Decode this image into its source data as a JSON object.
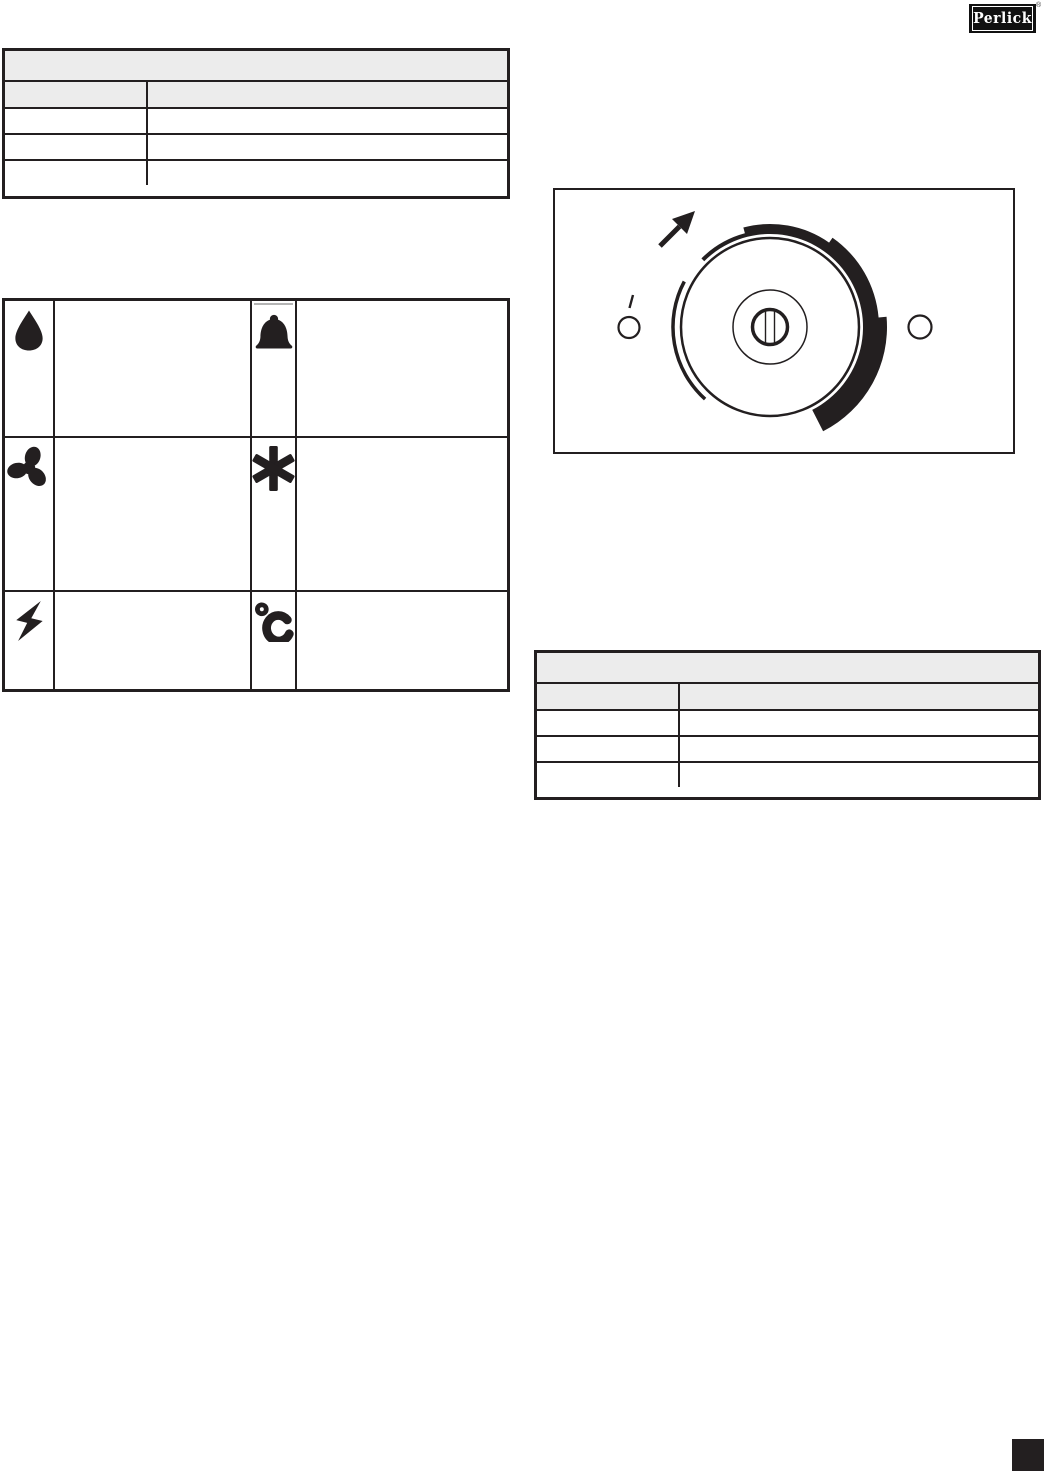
{
  "logo": {
    "text": "Perlick",
    "registered_mark": "®"
  },
  "colors": {
    "ink": "#231f20",
    "table_header_gray": "#ececec",
    "page_bg": "#ffffff"
  },
  "top_table": {
    "title": "",
    "headers": [
      "",
      ""
    ],
    "rows": [
      [
        "",
        ""
      ],
      [
        "",
        ""
      ],
      [
        "",
        ""
      ]
    ]
  },
  "icon_table": {
    "rows": [
      {
        "icon_left": "water-drop-icon",
        "text_left": "",
        "icon_right": "bell-icon",
        "text_right": ""
      },
      {
        "icon_left": "fan-icon",
        "text_left": "",
        "icon_right": "snowflake-icon",
        "text_right": ""
      },
      {
        "icon_left": "lightning-bolt-icon",
        "text_left": "",
        "icon_right": "temperature-celsius-icon",
        "text_right": ""
      }
    ]
  },
  "dial_figure": {
    "pointer_icon": "cursor-arrow-icon",
    "left_marker": "left-position-marker",
    "right_marker": "right-position-marker",
    "arc": "intensity-arc",
    "knob": "dial-knob"
  },
  "right_table": {
    "title": "",
    "headers": [
      "",
      ""
    ],
    "rows": [
      [
        "",
        ""
      ],
      [
        "",
        ""
      ],
      [
        "",
        ""
      ]
    ]
  },
  "footer": {
    "corner_block": ""
  }
}
